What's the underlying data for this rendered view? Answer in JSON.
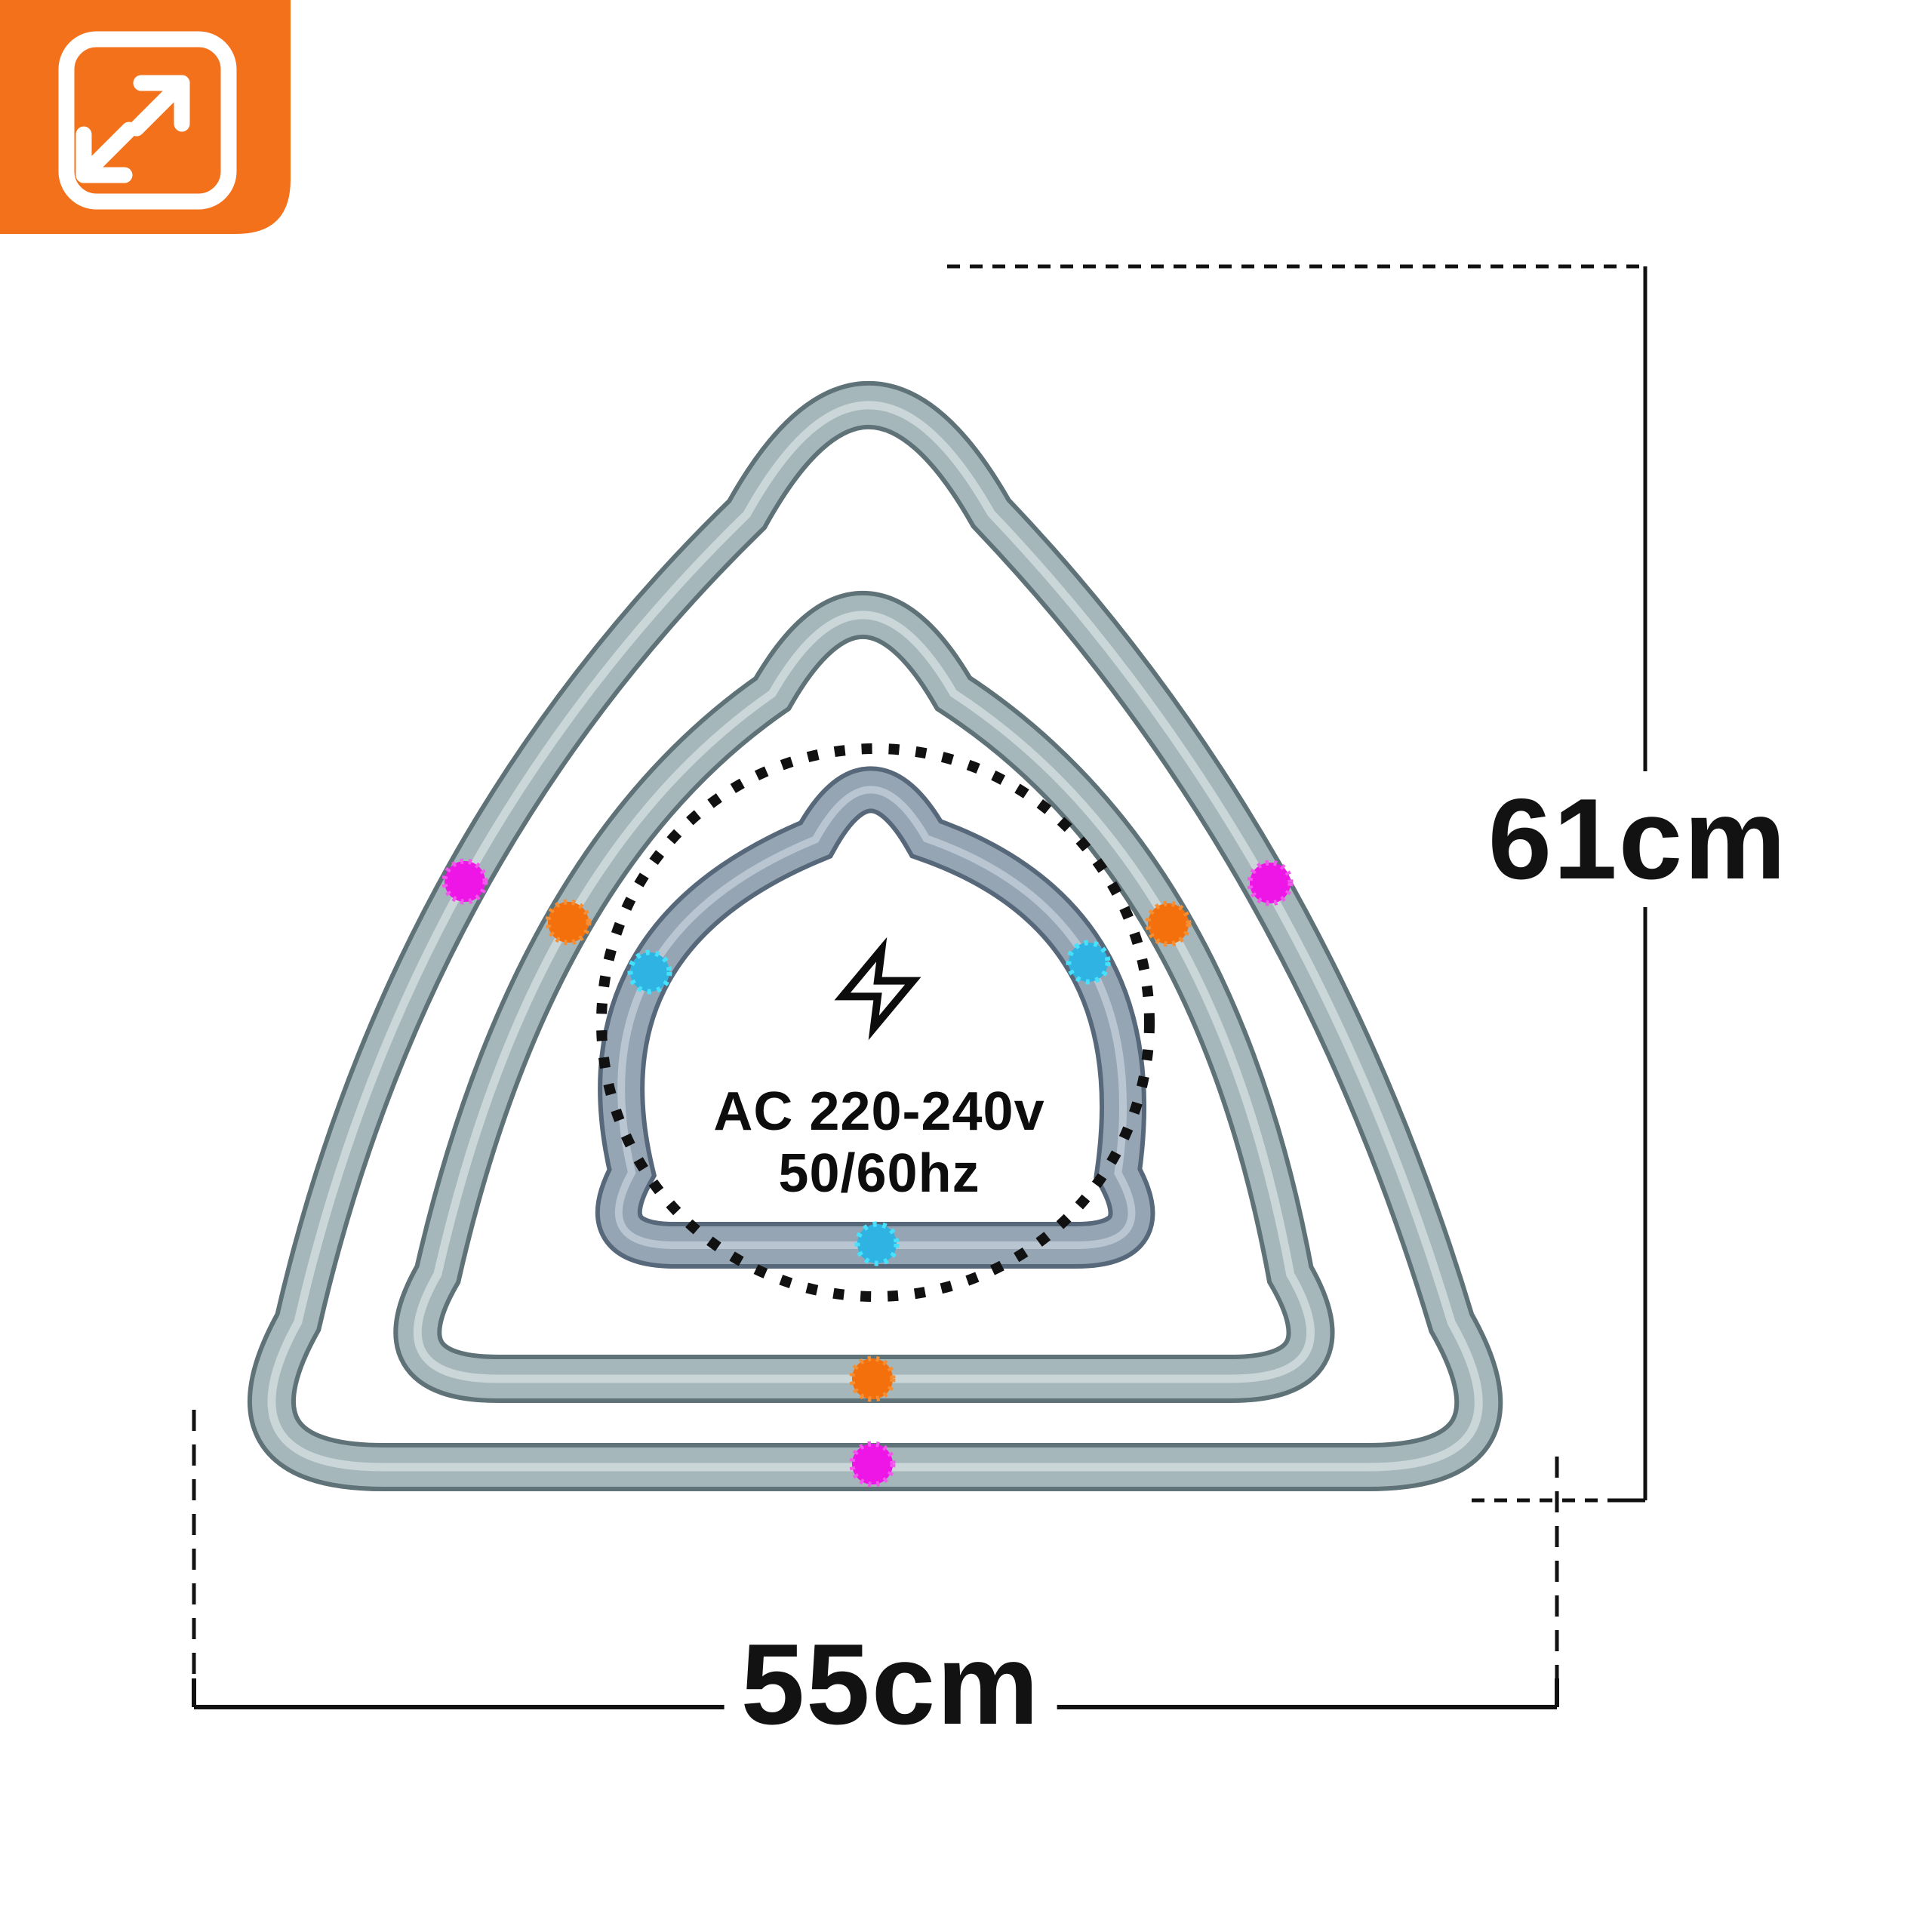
{
  "badge": {
    "icon": "expand-size-icon",
    "bg_color": "#f4711c",
    "icon_color": "#ffffff"
  },
  "diagram": {
    "description_icons": {
      "power_icon": "lightning-bolt-icon",
      "coverage_marker": "dotted-circle"
    },
    "power": {
      "line1": "AC 220-240v",
      "line2": "50/60hz"
    },
    "dimensions": {
      "height_label": "61cm",
      "width_label": "55cm"
    },
    "rings": [
      {
        "name": "outer-triangle-ring",
        "marker_color_name": "magenta"
      },
      {
        "name": "middle-triangle-ring",
        "marker_color_name": "orange"
      },
      {
        "name": "inner-triangle-ring",
        "marker_color_name": "cyan"
      }
    ],
    "colors": {
      "tube_edge": "#5e7278",
      "tube_main": "#a5b7ba",
      "tube_highlight": "#d0dcdd",
      "inner_tube_edge": "#57687b",
      "inner_tube_main": "#95a5b3",
      "inner_tube_highlight": "#c2cdd8",
      "marker_magenta": "#ee16e6",
      "marker_orange": "#f3700c",
      "marker_cyan": "#2fb3e3",
      "dimension_line": "#111111",
      "bolt": "#0c0c0c"
    }
  }
}
